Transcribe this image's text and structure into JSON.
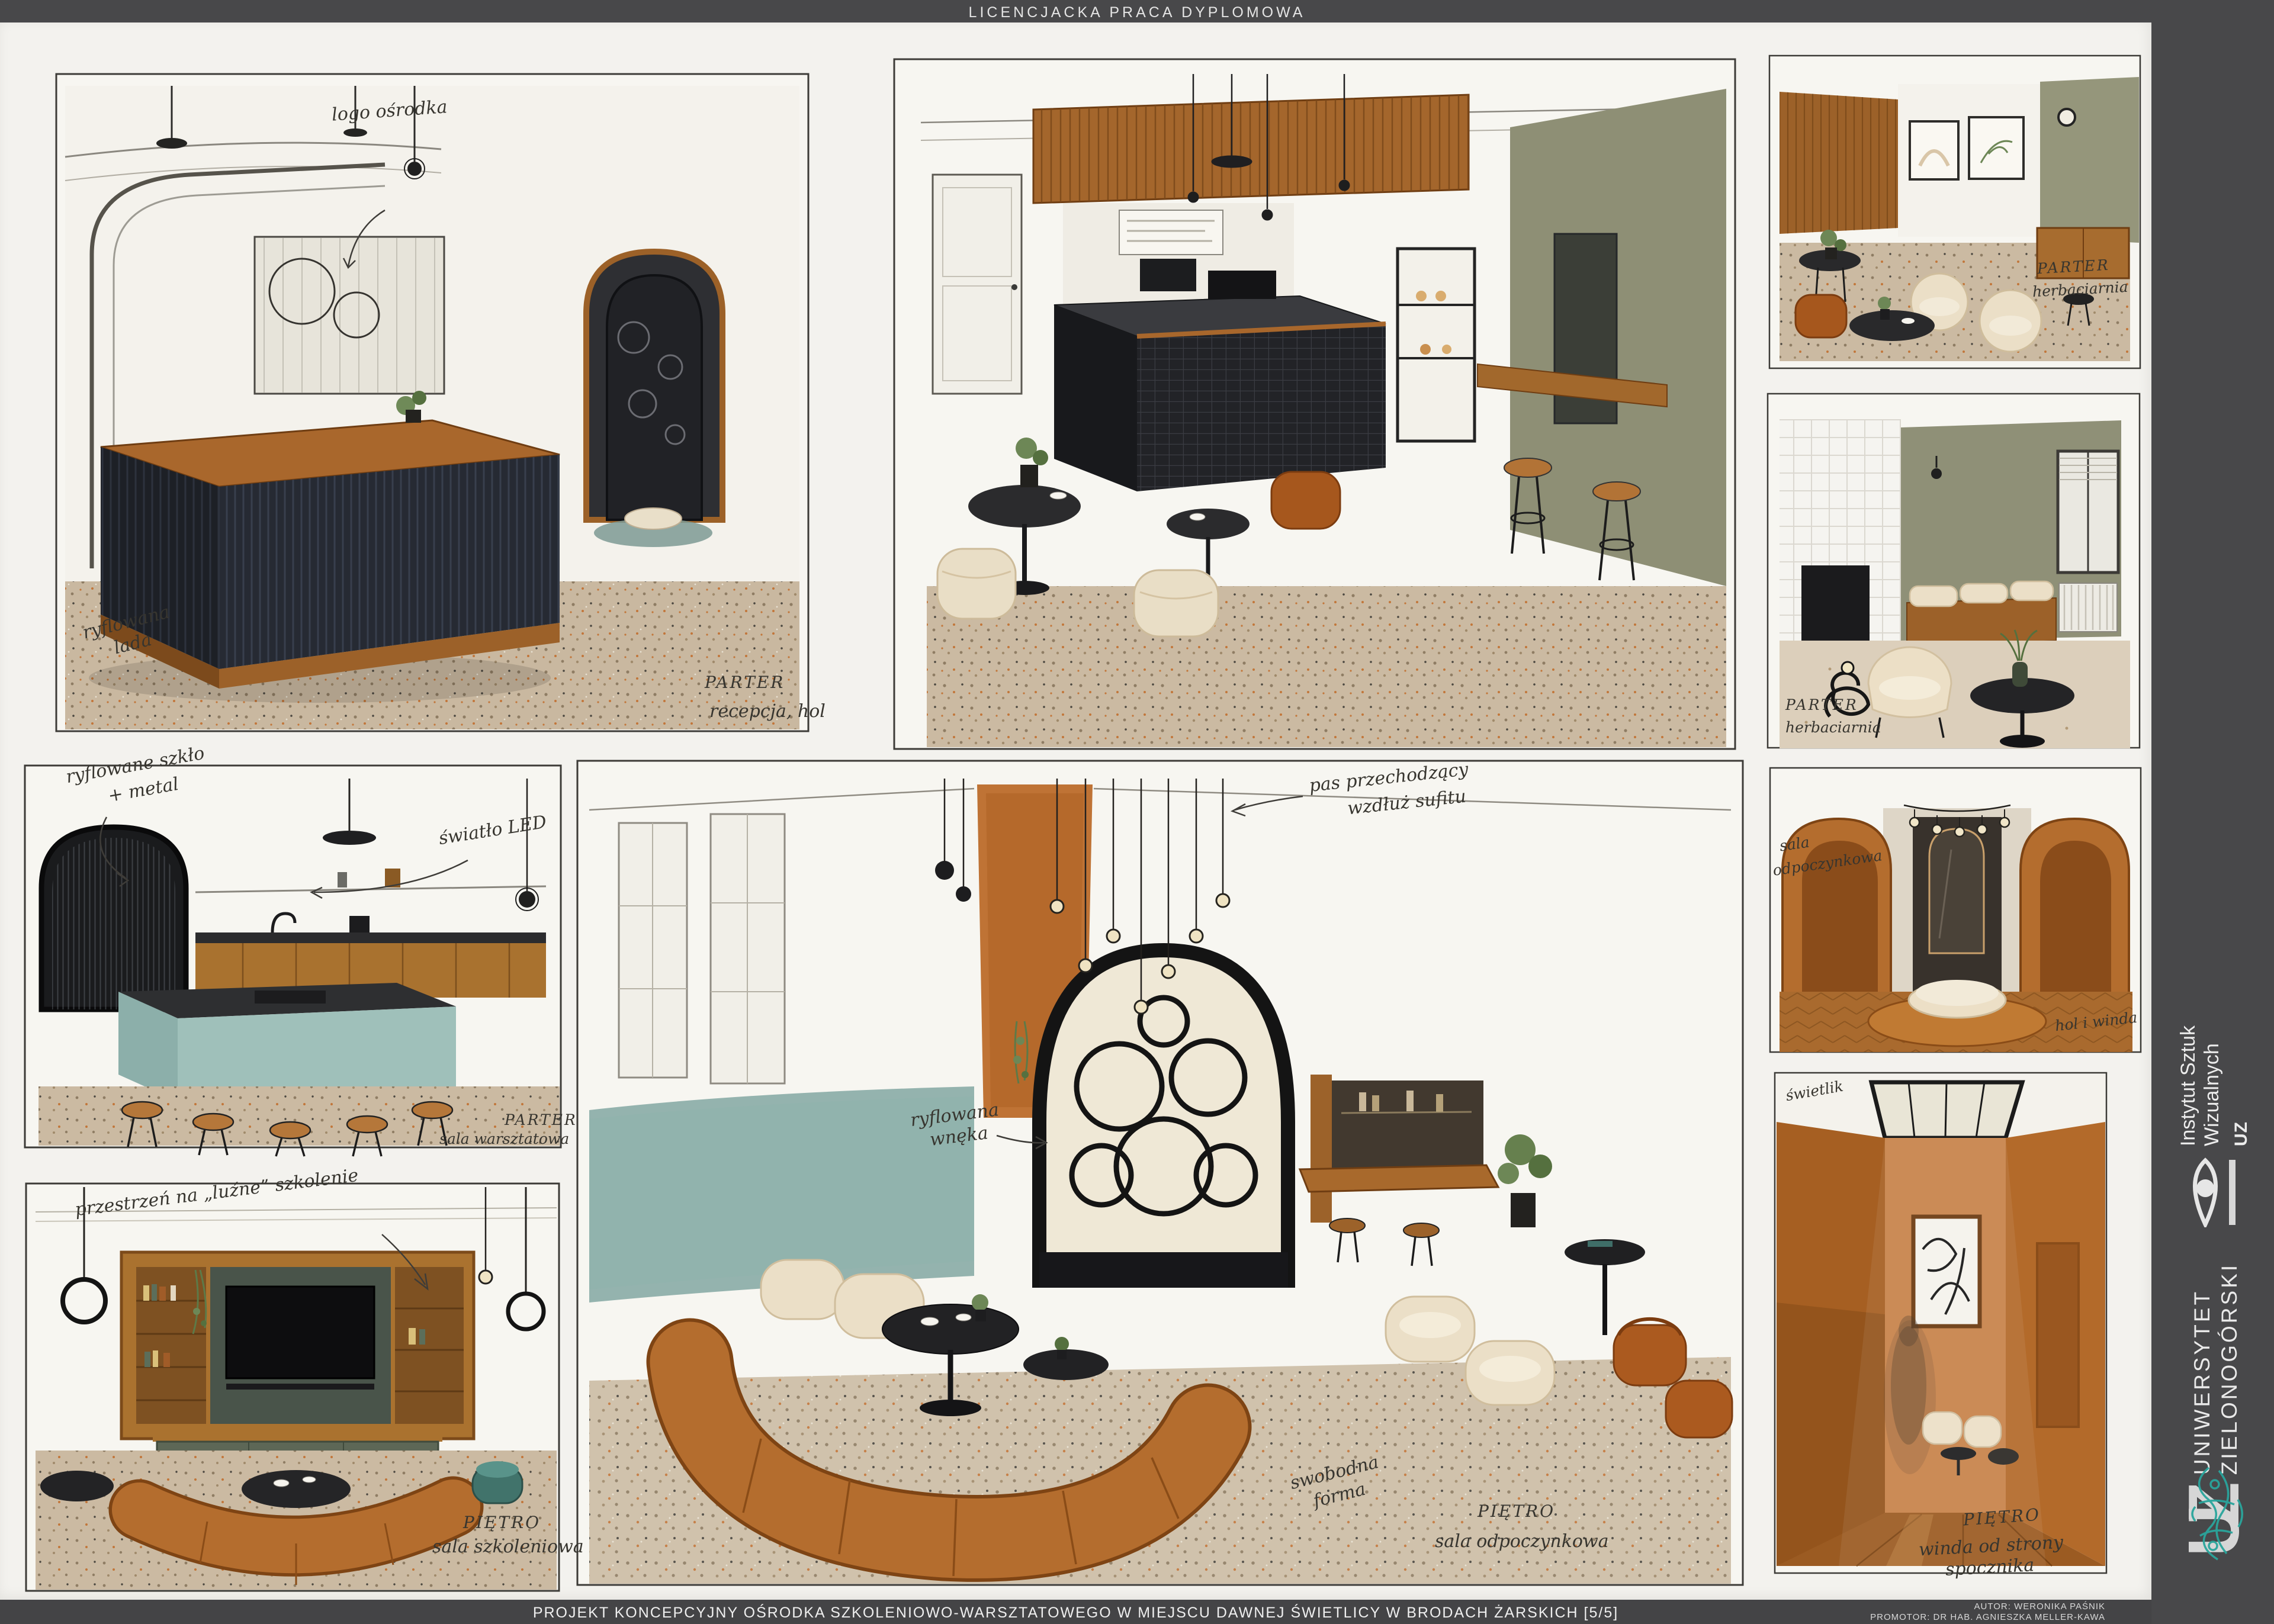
{
  "top_bar": {
    "title": "LICENCJACKA PRACA DYPLOMOWA"
  },
  "bottom_bar": {
    "title": "PROJEKT KONCEPCYJNY OŚRODKA SZKOLENIOWO-WARSZTATOWEGO W MIEJSCU DAWNEJ ŚWIETLICY W BRODACH ŻARSKICH [5/5]",
    "author": "AUTOR: WERONIKA PAŚNIK",
    "promoter": "PROMOTOR: DR HAB. AGNIESZKA MELLER-KAWA"
  },
  "sidebar": {
    "institute": {
      "line1": "Instytut Sztuk",
      "line2": "Wizualnych",
      "abbr": "UZ"
    },
    "university": {
      "line1": "UNIWERSYTET",
      "line2": "ZIELONOGÓRSKI",
      "logo": "UZ"
    },
    "colors": {
      "bar": "#48484a",
      "ornament_teal": "#2aa59c",
      "text": "#ececec"
    }
  },
  "panels": {
    "reception": {
      "logo_label": "logo ośrodka",
      "counter_label1": "ryflowana",
      "counter_label2": "lada",
      "floor": "PARTER",
      "room": "recepcja, hol"
    },
    "cafe": {
      "name": "kawiarnia / bar"
    },
    "tearoom": {
      "floor": "PARTER",
      "room": "herbaciarnia"
    },
    "tearoom_detail": {
      "floor": "PARTER",
      "room": "herbaciarnia"
    },
    "workshop_kitchen": {
      "glass_label1": "ryflowane szkło",
      "glass_label2": "+ metal",
      "led_label": "światło LED",
      "floor": "PARTER",
      "room": "sala warsztatowa"
    },
    "rest_hall": {
      "ceiling_label1": "pas przechodzący",
      "ceiling_label2": "wzdłuż sufitu",
      "niche_label1": "ryflowana",
      "niche_label2": "wnęka",
      "sofa_label1": "swobodna",
      "sofa_label2": "forma",
      "floor": "PIĘTRO",
      "room": "sala odpoczynkowa"
    },
    "upper_hall": {
      "left_label1": "sala",
      "left_label2": "odpoczynkowa",
      "bottom_label": "hol i winda"
    },
    "lift_corridor": {
      "skylight_label": "świetlik",
      "floor": "PIĘTRO",
      "room1": "winda od strony",
      "room2": "spocznika"
    },
    "training_room": {
      "top_label": "przestrzeń na „luźne” szkolenie",
      "floor": "PIĘTRO",
      "room": "sala szkoleniowa"
    }
  }
}
